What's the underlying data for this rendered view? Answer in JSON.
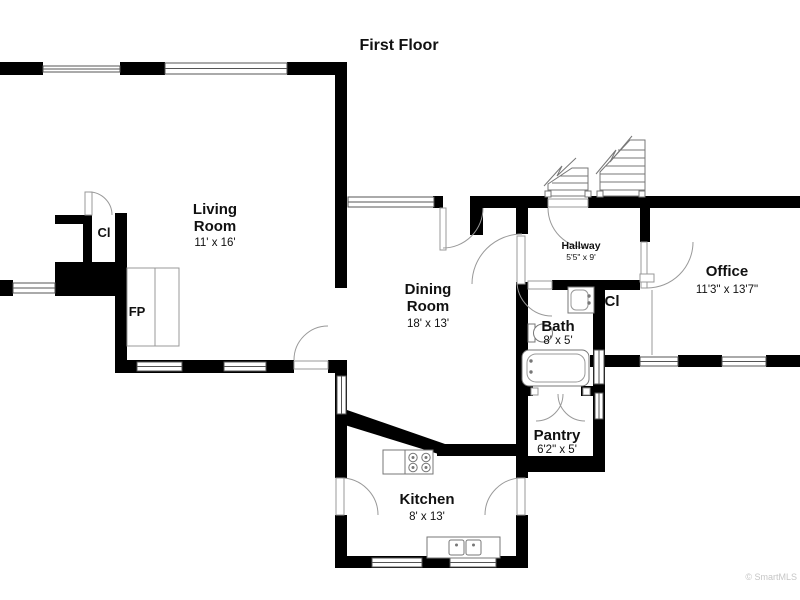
{
  "title": "First Floor",
  "watermark": "© SmartMLS",
  "rooms": [
    {
      "id": "living-room",
      "name": "Living Room",
      "lines": [
        "Living",
        "Room"
      ],
      "dims": "11' x 16'"
    },
    {
      "id": "dining-room",
      "name": "Dining Room",
      "lines": [
        "Dining",
        "Room"
      ],
      "dims": "18' x 13'"
    },
    {
      "id": "kitchen",
      "name": "Kitchen",
      "lines": [
        "Kitchen"
      ],
      "dims": "8' x 13'"
    },
    {
      "id": "office",
      "name": "Office",
      "lines": [
        "Office"
      ],
      "dims": "11'3\" x 13'7\""
    },
    {
      "id": "hallway",
      "name": "Hallway",
      "lines": [
        "Hallway"
      ],
      "dims": "5'5\" x 9'"
    },
    {
      "id": "bath",
      "name": "Bath",
      "lines": [
        "Bath"
      ],
      "dims": "8' x 5'"
    },
    {
      "id": "pantry",
      "name": "Pantry",
      "lines": [
        "Pantry"
      ],
      "dims": "6'2\" x 5'"
    }
  ],
  "labels": {
    "closet_living": "Cl",
    "closet_hall": "Cl",
    "fireplace": "FP"
  },
  "colors": {
    "wall": "#000000",
    "background": "#ffffff",
    "line": "#777777",
    "watermark": "#c6c6c6"
  }
}
